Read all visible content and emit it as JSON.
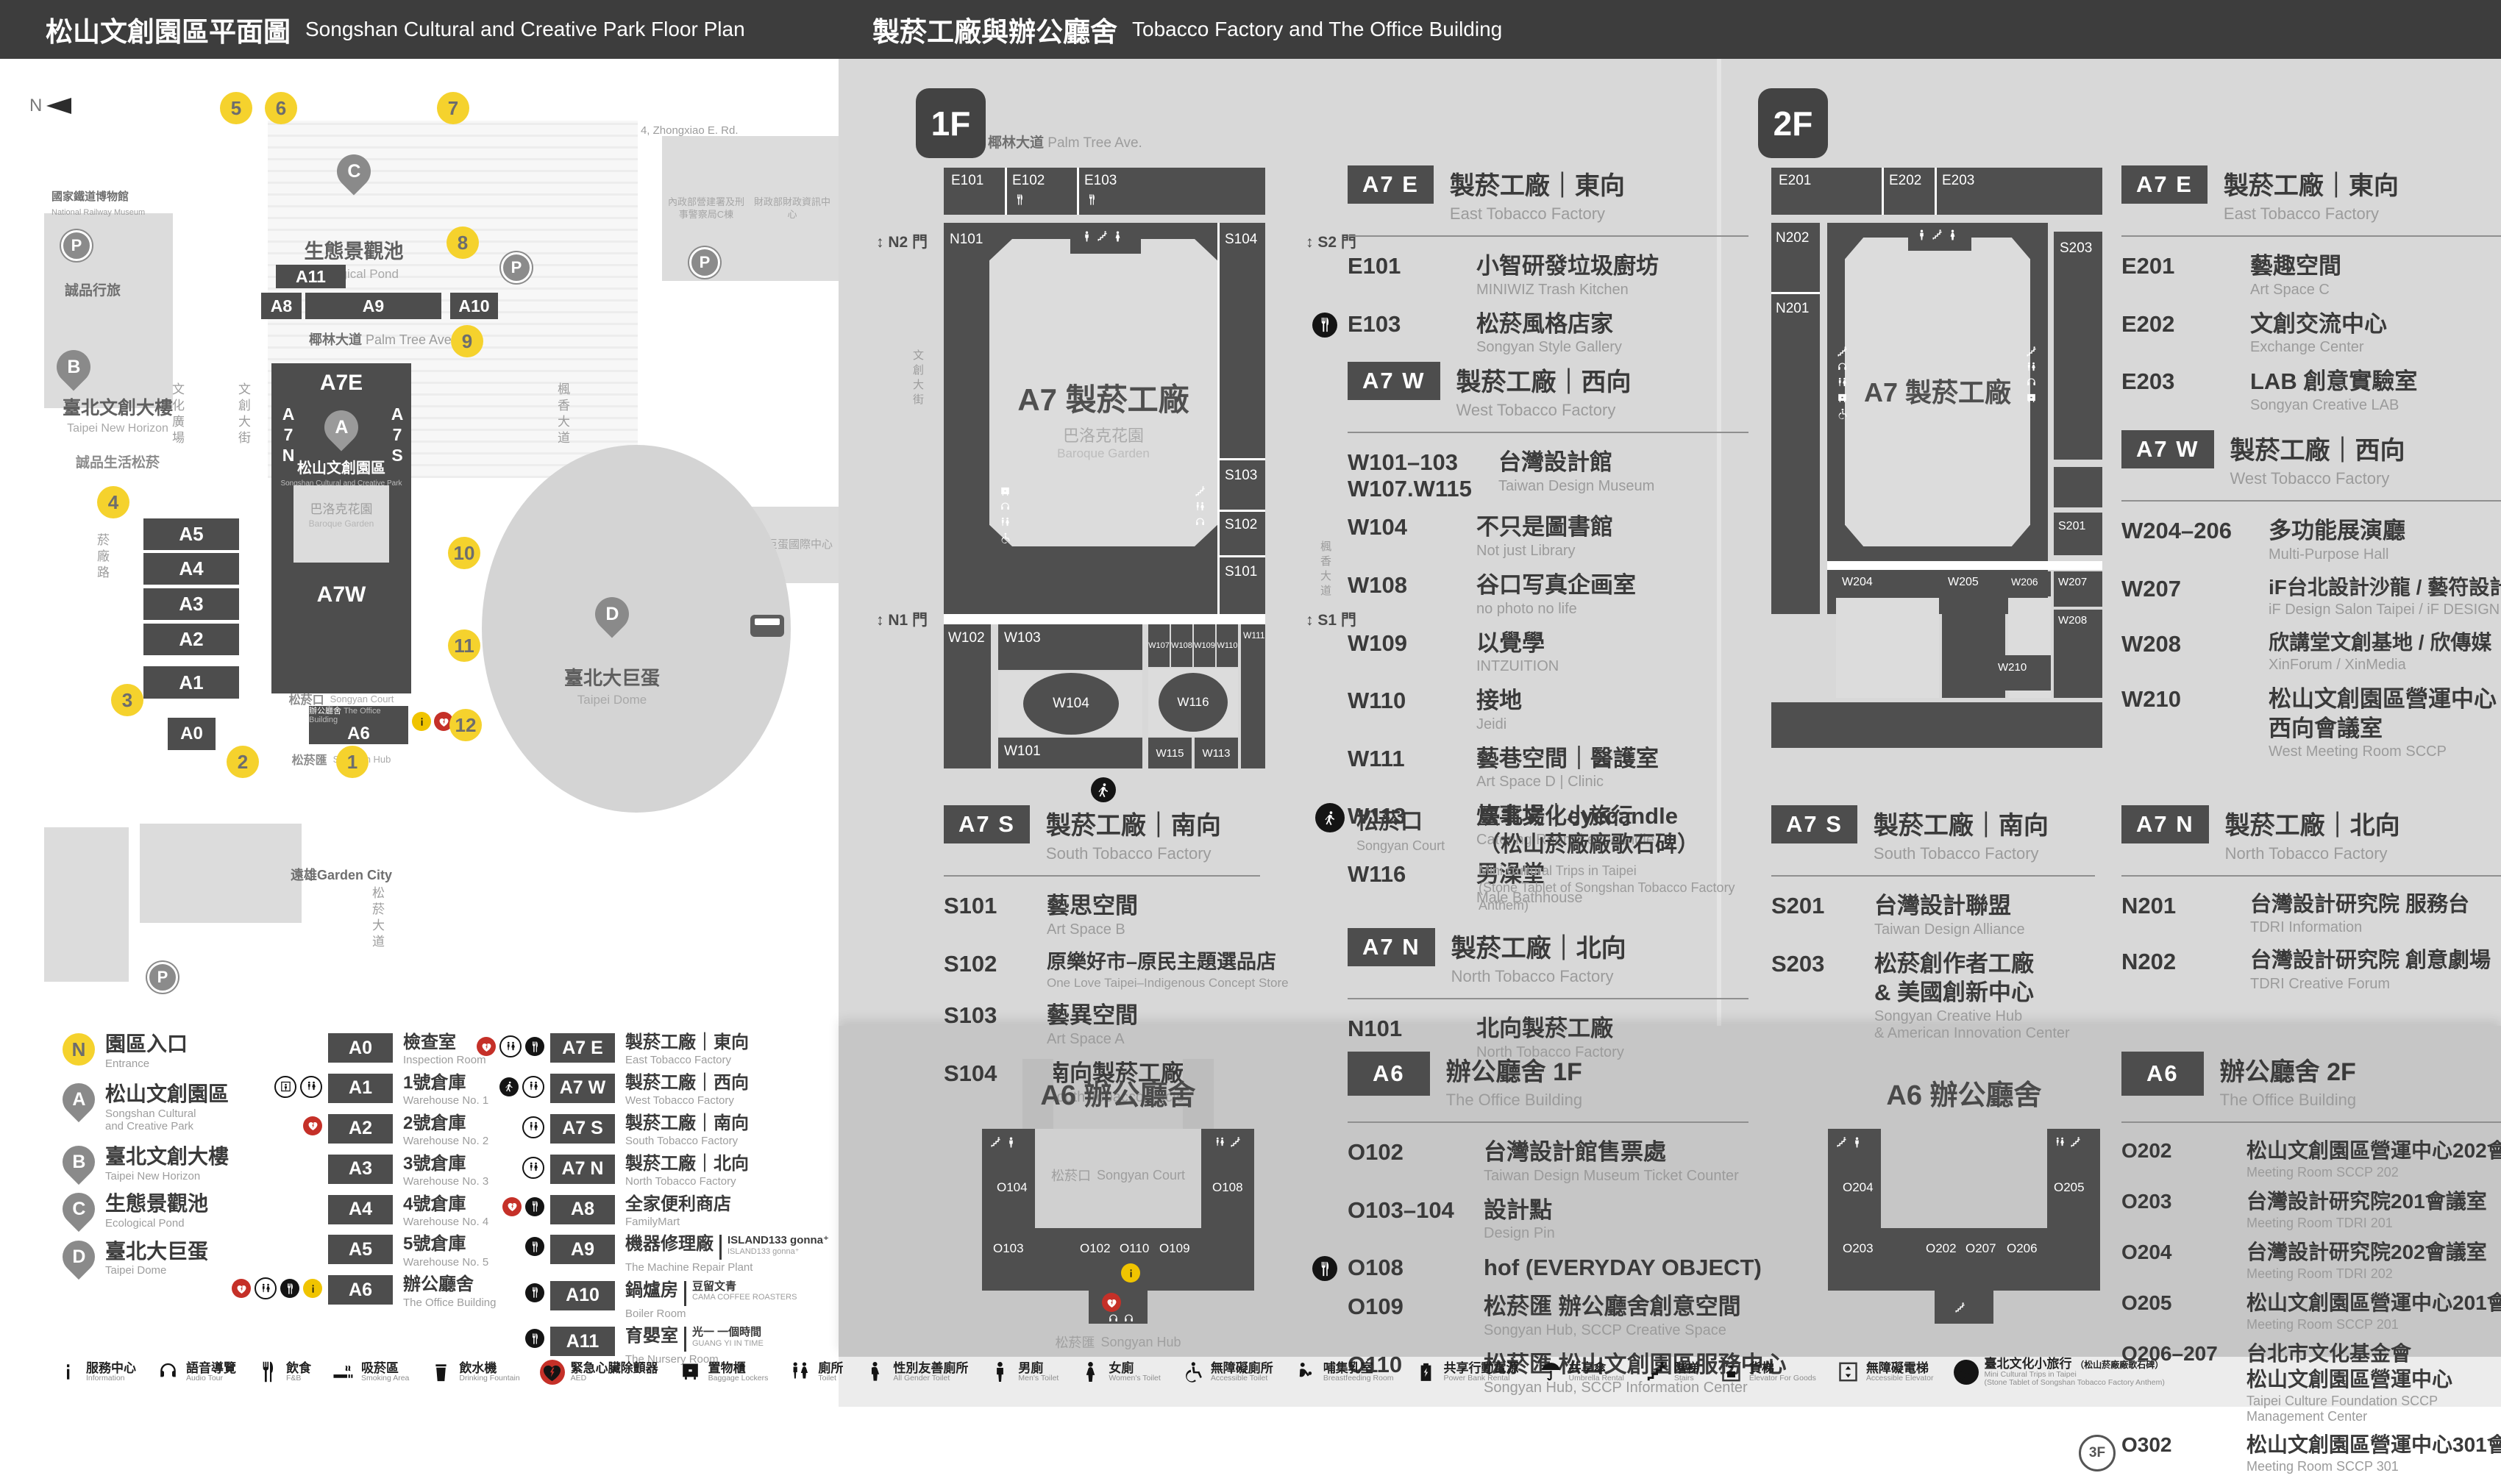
{
  "header": {
    "left": {
      "zh": "松山文創園區平面圖",
      "en": "Songshan Cultural and Creative Park Floor Plan"
    },
    "right": {
      "zh": "製菸工廠與辦公廳舍",
      "en": "Tobacco Factory and The Office Building"
    }
  },
  "colors": {
    "accent_yellow": "#f5d22d",
    "aed_red": "#c53028",
    "block_dark": "#4d4d4d",
    "panel_gray": "#d8d8d8"
  },
  "map": {
    "north": "N",
    "streets": {
      "top": {
        "zh": "忠孝東路四段553巷",
        "en": "Ln. 553, Sec. 4, Zhongxiao E. Rd."
      },
      "palm": {
        "zh": "椰林大道",
        "en": "Palm Tree Ave."
      },
      "cultural_plaza": {
        "zh": "文化廣場",
        "en": "Cultural Plaza"
      },
      "creative_blvd": {
        "zh": "文創大街",
        "en": "Cultural & Creative Blvd."
      },
      "maple": {
        "zh": "楓香大道",
        "en": "Maple Tree Ave."
      },
      "yanchang": {
        "zh": "菸廠路",
        "en": "Yanchang Rd."
      },
      "songyan_blvd": {
        "zh": "松菸大道",
        "en": ""
      }
    },
    "places": {
      "railway_museum": {
        "zh": "國家鐵道博物館",
        "en": "National Railway Museum"
      },
      "gov_c": {
        "zh": "內政部營建署及刑事警察局C棟",
        "en": ""
      },
      "mof": {
        "zh": "財政部財政資訊中心",
        "en": ""
      },
      "hotel": {
        "zh": "臺北洲際酒店",
        "en": ""
      },
      "dome_center": {
        "zh": "巨蛋國際中心",
        "en": ""
      },
      "eslite_hotel": {
        "zh": "誠品行旅",
        "en": ""
      },
      "new_horizon": {
        "zh": "臺北文創大樓",
        "en": "Taipei New Horizon"
      },
      "eslite_spectrum": {
        "zh": "誠品生活松菸",
        "en": ""
      },
      "garden_city": {
        "zh": "遠雄Garden City",
        "en": ""
      },
      "dome": {
        "zh": "臺北大巨蛋",
        "en": "Taipei Dome"
      },
      "pond": {
        "zh": "生態景觀池",
        "en": "Ecological Pond"
      },
      "park": {
        "zh": "松山文創園區",
        "en": "Songshan Cultural and Creative Park"
      },
      "baroque": {
        "zh": "巴洛克花園",
        "en": "Baroque Garden"
      },
      "court": {
        "zh": "松菸口",
        "en": "Songyan Court"
      },
      "office": {
        "zh": "辦公廳舍",
        "en": "The Office Building"
      },
      "hub": {
        "zh": "松菸匯",
        "en": "Songyan Hub"
      }
    },
    "buildings": [
      "A11",
      "A8",
      "A9",
      "A10",
      "A7E",
      "A7N",
      "A7S",
      "A7W",
      "A6",
      "A5",
      "A4",
      "A3",
      "A2",
      "A1",
      "A0"
    ],
    "markers": [
      "1",
      "2",
      "3",
      "4",
      "5",
      "6",
      "7",
      "8",
      "9",
      "10",
      "11",
      "12"
    ],
    "parking": "P"
  },
  "legend": {
    "pins": [
      {
        "id": "N",
        "zh": "園區入口",
        "en": "Entrance"
      },
      {
        "id": "A",
        "zh": "松山文創園區",
        "en1": "Songshan Cultural",
        "en2": "and Creative Park"
      },
      {
        "id": "B",
        "zh": "臺北文創大樓",
        "en1": "Taipei New Horizon",
        "en2": ""
      },
      {
        "id": "C",
        "zh": "生態景觀池",
        "en1": "Ecological Pond",
        "en2": ""
      },
      {
        "id": "D",
        "zh": "臺北大巨蛋",
        "en1": "Taipei Dome",
        "en2": ""
      }
    ],
    "col2": [
      {
        "id": "A0",
        "zh": "檢查室",
        "en": "Inspection Room",
        "icons": []
      },
      {
        "id": "A1",
        "zh": "1號倉庫",
        "en": "Warehouse No. 1",
        "icons": [
          "elevator",
          "toilet"
        ]
      },
      {
        "id": "A2",
        "zh": "2號倉庫",
        "en": "Warehouse No. 2",
        "icons": [
          "aed"
        ]
      },
      {
        "id": "A3",
        "zh": "3號倉庫",
        "en": "Warehouse No. 3",
        "icons": []
      },
      {
        "id": "A4",
        "zh": "4號倉庫",
        "en": "Warehouse No. 4",
        "icons": []
      },
      {
        "id": "A5",
        "zh": "5號倉庫",
        "en": "Warehouse No. 5",
        "icons": []
      },
      {
        "id": "A6",
        "zh": "辦公廳舍",
        "en": "The Office Building",
        "icons": [
          "aed",
          "toilet",
          "fnb",
          "info"
        ]
      }
    ],
    "col3": [
      {
        "id": "A7 E",
        "zh": "製菸工廠｜東向",
        "en": "East Tobacco Factory",
        "icons": [
          "aed",
          "toilet",
          "fnb"
        ]
      },
      {
        "id": "A7 W",
        "zh": "製菸工廠｜西向",
        "en": "West Tobacco Factory",
        "icons": [
          "trip",
          "toilet"
        ]
      },
      {
        "id": "A7 S",
        "zh": "製菸工廠｜南向",
        "en": "South Tobacco Factory",
        "icons": [
          "toilet"
        ]
      },
      {
        "id": "A7 N",
        "zh": "製菸工廠｜北向",
        "en": "North Tobacco Factory",
        "icons": [
          "toilet"
        ]
      },
      {
        "id": "A8",
        "zh": "全家便利商店",
        "en": "FamilyMart",
        "icons": [
          "aed",
          "fnb"
        ]
      },
      {
        "id": "A9",
        "zh": "機器修理廠",
        "en": "The Machine Repair Plant",
        "note_zh": "ISLAND133 gonna⁺",
        "note_en": "ISLAND133 gonna⁺",
        "icons": [
          "fnb"
        ]
      },
      {
        "id": "A10",
        "zh": "鍋爐房",
        "en": "Boiler Room",
        "note_zh": "豆留文青",
        "note_en": "CAMA COFFEE ROASTERS",
        "icons": [
          "fnb"
        ]
      },
      {
        "id": "A11",
        "zh": "育嬰室",
        "en": "The Nursery Room",
        "note_zh": "光一 一個時間",
        "note_en": "GUANG YI IN TIME",
        "icons": [
          "fnb"
        ]
      }
    ]
  },
  "amenities": [
    {
      "icon": "info",
      "zh": "服務中心",
      "en": "Information"
    },
    {
      "icon": "audio",
      "zh": "語音導覽",
      "en": "Audio Tour"
    },
    {
      "icon": "fnb",
      "zh": "飲食",
      "en": "F&B"
    },
    {
      "icon": "smoking",
      "zh": "吸菸區",
      "en": "Smoking Area"
    },
    {
      "icon": "fountain",
      "zh": "飲水機",
      "en": "Drinking Fountain"
    },
    {
      "icon": "aed",
      "zh": "緊急心臟除顫器",
      "en": "AED"
    },
    {
      "icon": "locker",
      "zh": "置物櫃",
      "en": "Baggage Lockers"
    },
    {
      "icon": "toilet",
      "zh": "廁所",
      "en": "Toilet"
    },
    {
      "icon": "allgender",
      "zh": "性別友善廁所",
      "en": "All Gender Toilet"
    },
    {
      "icon": "men",
      "zh": "男廁",
      "en": "Men's Toilet"
    },
    {
      "icon": "women",
      "zh": "女廁",
      "en": "Women's Toilet"
    },
    {
      "icon": "accessible",
      "zh": "無障礙廁所",
      "en": "Accessible Toilet"
    },
    {
      "icon": "nursing",
      "zh": "哺集乳室",
      "en": "Breastfeeding Room"
    },
    {
      "icon": "powerbank",
      "zh": "共享行動電源",
      "en": "Power Bank Rental"
    },
    {
      "icon": "umbrella",
      "zh": "共享傘",
      "en": "Umbrella Rental"
    },
    {
      "icon": "stairs",
      "zh": "階梯",
      "en": "Stairs"
    },
    {
      "icon": "cargo",
      "zh": "貨梯",
      "en": "Elevator For Goods"
    },
    {
      "icon": "accelev",
      "zh": "無障礙電梯",
      "en": "Accessible Elevator"
    },
    {
      "icon": "trip",
      "zh": "臺北文化小旅行",
      "zh2": "（松山菸廠廠歌石碑）",
      "en": "Mini Cultural Trips in Taipei",
      "en2": "(Stone Tablet of Songshan Tobacco Factory Anthem)"
    }
  ],
  "floor1": {
    "badge": "1F",
    "plan": {
      "street_top_zh": "椰林大道",
      "street_top_en": "Palm Tree Ave.",
      "street_left_zh": "文創大街",
      "street_left_en": "Cultural & Creative Blvd.",
      "street_right_zh": "楓香大道",
      "street_right_en": "Maple Tree Ave.",
      "gates": {
        "n2": "N2 門",
        "s2": "S2 門",
        "n1": "N1 門",
        "s1": "S1 門"
      },
      "center": "A7 製菸工廠",
      "garden_zh": "巴洛克花園",
      "garden_en": "Baroque Garden",
      "rooms_top": [
        "E101",
        "E102",
        "E103"
      ],
      "room_left": "N101",
      "rooms_right": [
        "S104",
        "S103",
        "S102",
        "S101"
      ],
      "rooms_bottom": [
        "W102",
        "W103",
        "W104",
        "W101",
        "W107",
        "W108",
        "W109",
        "W110",
        "W116",
        "W115",
        "W113",
        "W111"
      ]
    },
    "sections": [
      {
        "badge": "A7 E",
        "zh": "製菸工廠｜東向",
        "en": "East Tobacco Factory",
        "rooms": [
          {
            "id": "E101",
            "zh": "小智研發垃圾廚坊",
            "en": "MINIWIZ Trash Kitchen"
          },
          {
            "id": "E103",
            "zh": "松菸風格店家",
            "en": "Songyan Style Gallery",
            "icon": "fnb"
          }
        ]
      },
      {
        "badge": "A7 W",
        "zh": "製菸工廠｜西向",
        "en": "West Tobacco Factory",
        "rooms": [
          {
            "id": "W101–103",
            "id2": "W107.W115",
            "zh": "台灣設計館",
            "en": "Taiwan Design Museum"
          },
          {
            "id": "W104",
            "zh": "不只是圖書館",
            "en": "Not just Library"
          },
          {
            "id": "W108",
            "zh": "谷口写真企画室",
            "en": "no photo no life"
          },
          {
            "id": "W109",
            "zh": "以覺學",
            "en": "INTZUITION"
          },
          {
            "id": "W110",
            "zh": "接地",
            "en": "Jeidi"
          },
          {
            "id": "W111",
            "zh": "藝巷空間｜醫護室",
            "en": "Art Space D | Clinic"
          },
          {
            "id": "W113",
            "zh": "炊事場｜eyecandle",
            "en": "Catering Room | eyecandle"
          },
          {
            "id": "W116",
            "zh": "男澡堂",
            "en": "Male Bathhouse"
          }
        ]
      },
      {
        "badge": "A7 S",
        "zh": "製菸工廠｜南向",
        "en": "South Tobacco Factory",
        "rooms": [
          {
            "id": "S101",
            "zh": "藝思空間",
            "en": "Art Space B"
          },
          {
            "id": "S102",
            "zh": "原樂好市–原民主題選品店",
            "en": "One Love Taipei–Indigenous Concept Store"
          },
          {
            "id": "S103",
            "zh": "藝異空間",
            "en": "Art Space A"
          },
          {
            "id": "S104",
            "zh": "南向製菸工廠",
            "en": "South Tobacco Factory"
          }
        ]
      },
      {
        "badge": "A7 N",
        "zh": "製菸工廠｜北向",
        "en": "North Tobacco Factory",
        "rooms": [
          {
            "id": "N101",
            "zh": "北向製菸工廠",
            "en": "North Tobacco Factory"
          }
        ]
      }
    ],
    "court": {
      "zh": "松菸口",
      "en": "Songyan Court",
      "title_zh": "臺北文化小旅行",
      "title_zh2": "（松山菸廠廠歌石碑）",
      "title_en": "Mini Cultural Trips in Taipei",
      "title_en2": "(Stone Tablet of Songshan Tobacco Factory Anthem)"
    },
    "a6": {
      "badge": "A6",
      "zh": "辦公廳舍 1F",
      "en": "The Office Building",
      "plan_title": "A6 辦公廳舍",
      "plan_court_zh": "松菸口",
      "plan_court_en": "Songyan Court",
      "plan_hub_zh": "松菸匯",
      "plan_hub_en": "Songyan Hub",
      "plan_rooms": [
        "O104",
        "O108",
        "O103",
        "O102",
        "O110",
        "O109"
      ],
      "rooms": [
        {
          "id": "O102",
          "zh": "台灣設計館售票處",
          "en": "Taiwan Design Museum Ticket Counter"
        },
        {
          "id": "O103–104",
          "zh": "設計點",
          "en": "Design Pin"
        },
        {
          "id": "O108",
          "zh": "hof (EVERYDAY OBJECT)",
          "en": "",
          "icon": "fnb"
        },
        {
          "id": "O109",
          "zh": "松菸匯 辦公廳舍創意空間",
          "en": "Songyan Hub, SCCP Creative Space"
        },
        {
          "id": "O110",
          "zh": "松菸匯 松山文創園區服務中心",
          "en": "Songyan Hub, SCCP Information Center"
        }
      ]
    }
  },
  "floor2": {
    "badge": "2F",
    "plan": {
      "center": "A7 製菸工廠",
      "rooms_top": [
        "E201",
        "E202",
        "E203"
      ],
      "rooms_left": [
        "N202",
        "N201"
      ],
      "rooms_right": [
        "S203",
        "S201"
      ],
      "rooms_bottom": [
        "W204",
        "W205",
        "W206",
        "W207",
        "W208",
        "W210"
      ]
    },
    "sections": [
      {
        "badge": "A7 E",
        "zh": "製菸工廠｜東向",
        "en": "East Tobacco Factory",
        "rooms": [
          {
            "id": "E201",
            "zh": "藝趣空間",
            "en": "Art Space C"
          },
          {
            "id": "E202",
            "zh": "文創交流中心",
            "en": "Exchange Center"
          },
          {
            "id": "E203",
            "zh": "LAB 創意實驗室",
            "en": "Songyan Creative LAB"
          }
        ]
      },
      {
        "badge": "A7 W",
        "zh": "製菸工廠｜西向",
        "en": "West Tobacco Factory",
        "rooms": [
          {
            "id": "W204–206",
            "zh": "多功能展演廳",
            "en": "Multi-Purpose Hall"
          },
          {
            "id": "W207",
            "zh": "iF台北設計沙龍 / 藝符設計",
            "en": "iF Design Salon Taipei / iF DESIGN ASIA"
          },
          {
            "id": "W208",
            "zh": "欣講堂文創基地 / 欣傳媒",
            "en": "XinForum / XinMedia"
          },
          {
            "id": "W210",
            "zh": "松山文創園區營運中心",
            "zh2": "西向會議室",
            "en": "West Meeting Room SCCP"
          }
        ]
      },
      {
        "badge": "A7 S",
        "zh": "製菸工廠｜南向",
        "en": "South Tobacco Factory",
        "rooms": [
          {
            "id": "S201",
            "zh": "台灣設計聯盟",
            "en": "Taiwan Design Alliance"
          },
          {
            "id": "S203",
            "zh": "松菸創作者工廠",
            "zh2": "& 美國創新中心",
            "en": "Songyan Creative Hub",
            "en2": "& American Innovation Center"
          }
        ]
      },
      {
        "badge": "A7 N",
        "zh": "製菸工廠｜北向",
        "en": "North Tobacco Factory",
        "rooms": [
          {
            "id": "N201",
            "zh": "台灣設計研究院 服務台",
            "en": "TDRI Information"
          },
          {
            "id": "N202",
            "zh": "台灣設計研究院 創意劇場",
            "en": "TDRI Creative Forum"
          }
        ]
      }
    ],
    "a6": {
      "badge": "A6",
      "zh": "辦公廳舍 2F",
      "en": "The Office Building",
      "plan_title": "A6 辦公廳舍",
      "plan_rooms": [
        "O204",
        "O205",
        "O203",
        "O202",
        "O207",
        "O206"
      ],
      "rooms": [
        {
          "id": "O202",
          "zh": "松山文創園區營運中心202會議室",
          "en": "Meeting Room SCCP 202"
        },
        {
          "id": "O203",
          "zh": "台灣設計研究院201會議室",
          "en": "Meeting Room TDRI 201"
        },
        {
          "id": "O204",
          "zh": "台灣設計研究院202會議室",
          "en": "Meeting Room TDRI 202"
        },
        {
          "id": "O205",
          "zh": "松山文創園區營運中心201會議室",
          "en": "Meeting Room SCCP 201"
        },
        {
          "id": "O206–207",
          "zh": "台北市文化基金會",
          "zh2": "松山文創園區營運中心",
          "en": "Taipei Culture Foundation SCCP Management Center"
        },
        {
          "id": "O302",
          "zh": "松山文創園區營運中心301會議室",
          "en": "Meeting Room SCCP 301",
          "badge": "3F"
        }
      ]
    }
  }
}
